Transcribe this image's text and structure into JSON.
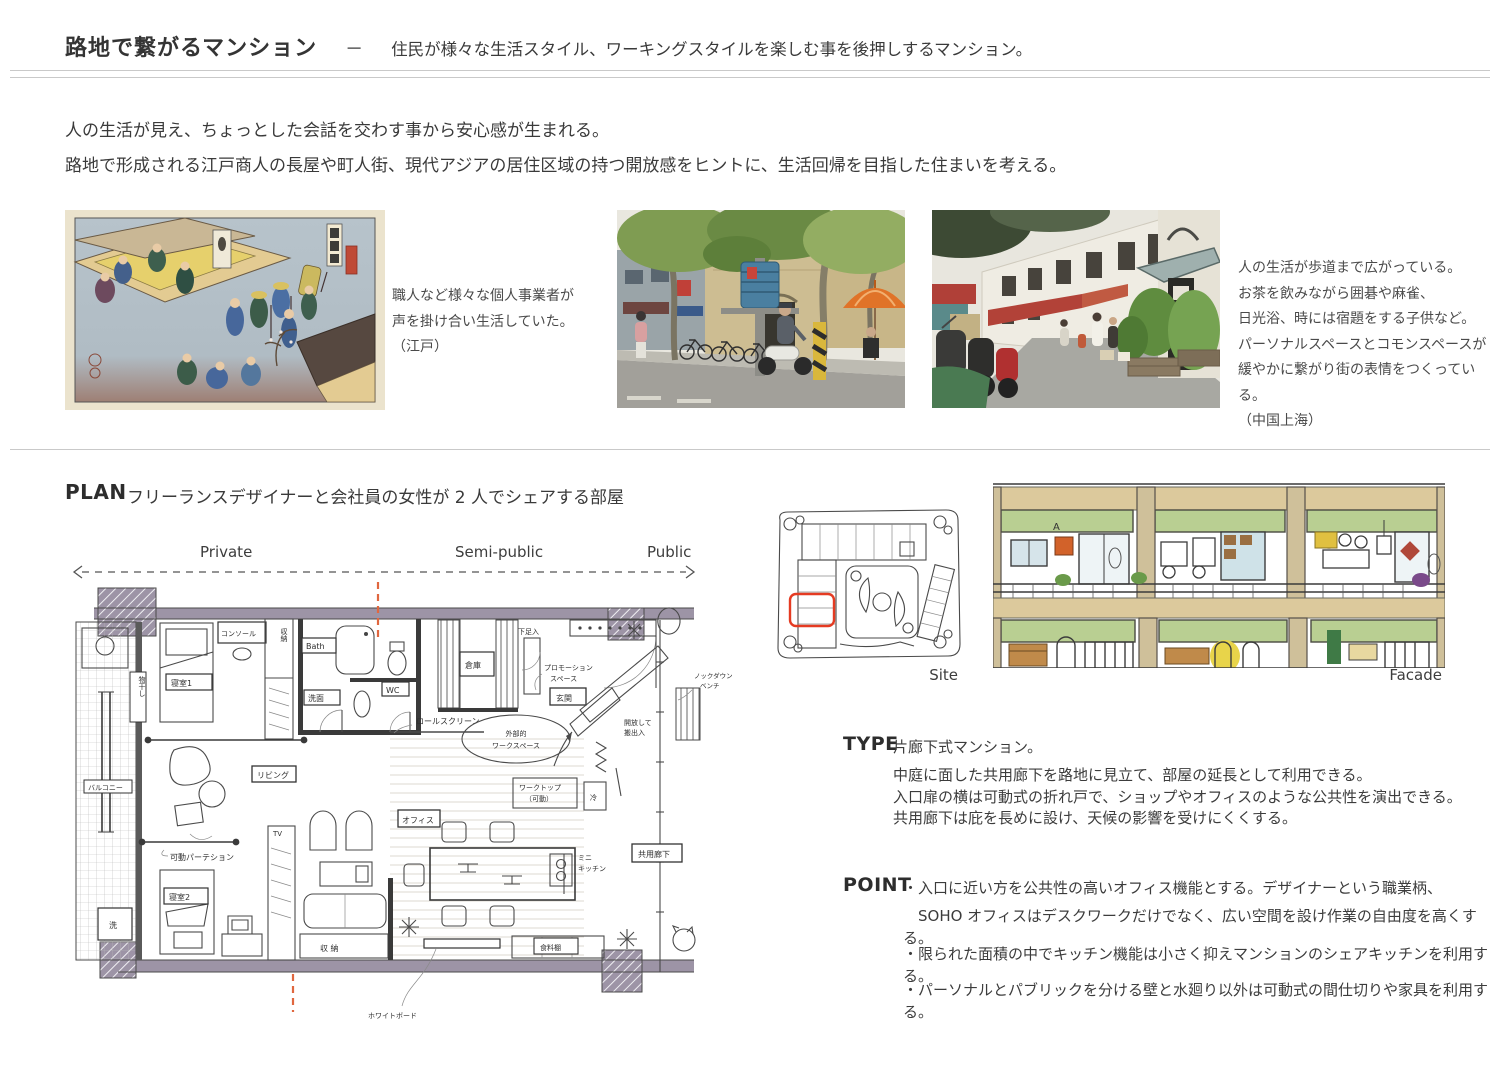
{
  "header": {
    "title": "路地で繋がるマンション",
    "dash": "－",
    "subtitle": "住民が様々な生活スタイル、ワーキングスタイルを楽しむ事を後押しするマンション。"
  },
  "intro": {
    "line1": "人の生活が見え、ちょっとした会話を交わす事から安心感が生まれる。",
    "line2": "路地で形成される江戸商人の長屋や町人街、現代アジアの居住区域の持つ開放感をヒントに、生活回帰を目指した住まいを考える。"
  },
  "references": {
    "edo": {
      "caption_lines": [
        "職人など様々な個人事業者が",
        "声を掛け合い生活していた。",
        "（江戸）"
      ]
    },
    "shanghai": {
      "caption_lines": [
        "人の生活が歩道まで広がっている。",
        "お茶を飲みながら囲碁や麻雀、",
        "日光浴、時には宿題をする子供など。",
        "パーソナルスペースとコモンスペースが",
        "緩やかに繋がり街の表情をつくっている。",
        "（中国上海）"
      ]
    }
  },
  "plan": {
    "heading": "PLAN",
    "description": "フリーランスデザイナーと会社員の女性が 2 人でシェアする部屋",
    "zones": [
      "Private",
      "Semi-public",
      "Public"
    ],
    "site_label": "Site",
    "facade_label": "Facade",
    "labels": {
      "console": "コンソール",
      "bedroom1": "寝室1",
      "closet": "収納",
      "bath": "Bath",
      "washstand": "洗面",
      "wc": "WC",
      "storeroom": "倉庫",
      "shoebox": "下足入",
      "promotion_l1": "プロモーション",
      "promotion_l2": "スペース",
      "entrance": "玄関",
      "rollscreen": "ロールスクリーン",
      "ext_ws_l1": "外部的",
      "ext_ws_l2": "ワークスペース",
      "open_l1": "開放して",
      "open_l2": "搬出入",
      "worktop_l1": "ワークトップ",
      "worktop_l2": "（可動）",
      "fridge": "冷",
      "office": "オフィス",
      "living": "リビング",
      "partition": "可動パーテション",
      "bedroom2": "寝室2",
      "wash": "洗",
      "tv": "TV",
      "storage": "収 納",
      "minikitchen_l1": "ミニ",
      "minikitchen_l2": "キッチン",
      "corridor": "共用廊下",
      "foodshelf": "食料棚",
      "balcony": "バルコニー",
      "drying": "物干し",
      "bench_l1": "ノックダウン",
      "bench_l2": "ベンチ",
      "whiteboard": "ホワイトボード"
    }
  },
  "type": {
    "heading": "TYPE",
    "intro": "片廊下式マンション。",
    "lines": [
      "中庭に面した共用廊下を路地に見立て、部屋の延長として利用できる。",
      "入口扉の横は可動式の折れ戸で、ショップやオフィスのような公共性を演出できる。",
      "共用廊下は庇を長めに設け、天候の影響を受けにくくする。"
    ]
  },
  "point": {
    "heading": "POINT",
    "bullets": [
      "・入口に近い方を公共性の高いオフィス機能とする。デザイナーという職業柄、",
      "　SOHO オフィスはデスクワークだけでなく、広い空間を設け作業の自由度を高くする。",
      "・限られた面積の中でキッチン機能は小さく抑えマンションのシェアキッチンを利用する。",
      "・パーソナルとパブリックを分ける壁と水廻り以外は可動式の間仕切りや家具を利用する。"
    ]
  },
  "colors": {
    "zone_line_orange": "#e0673f",
    "site_highlight_red": "#e53b22",
    "wall_purple": "#9d94a6",
    "facade_green": "#b9cf92",
    "facade_tan": "#d9c89b"
  }
}
